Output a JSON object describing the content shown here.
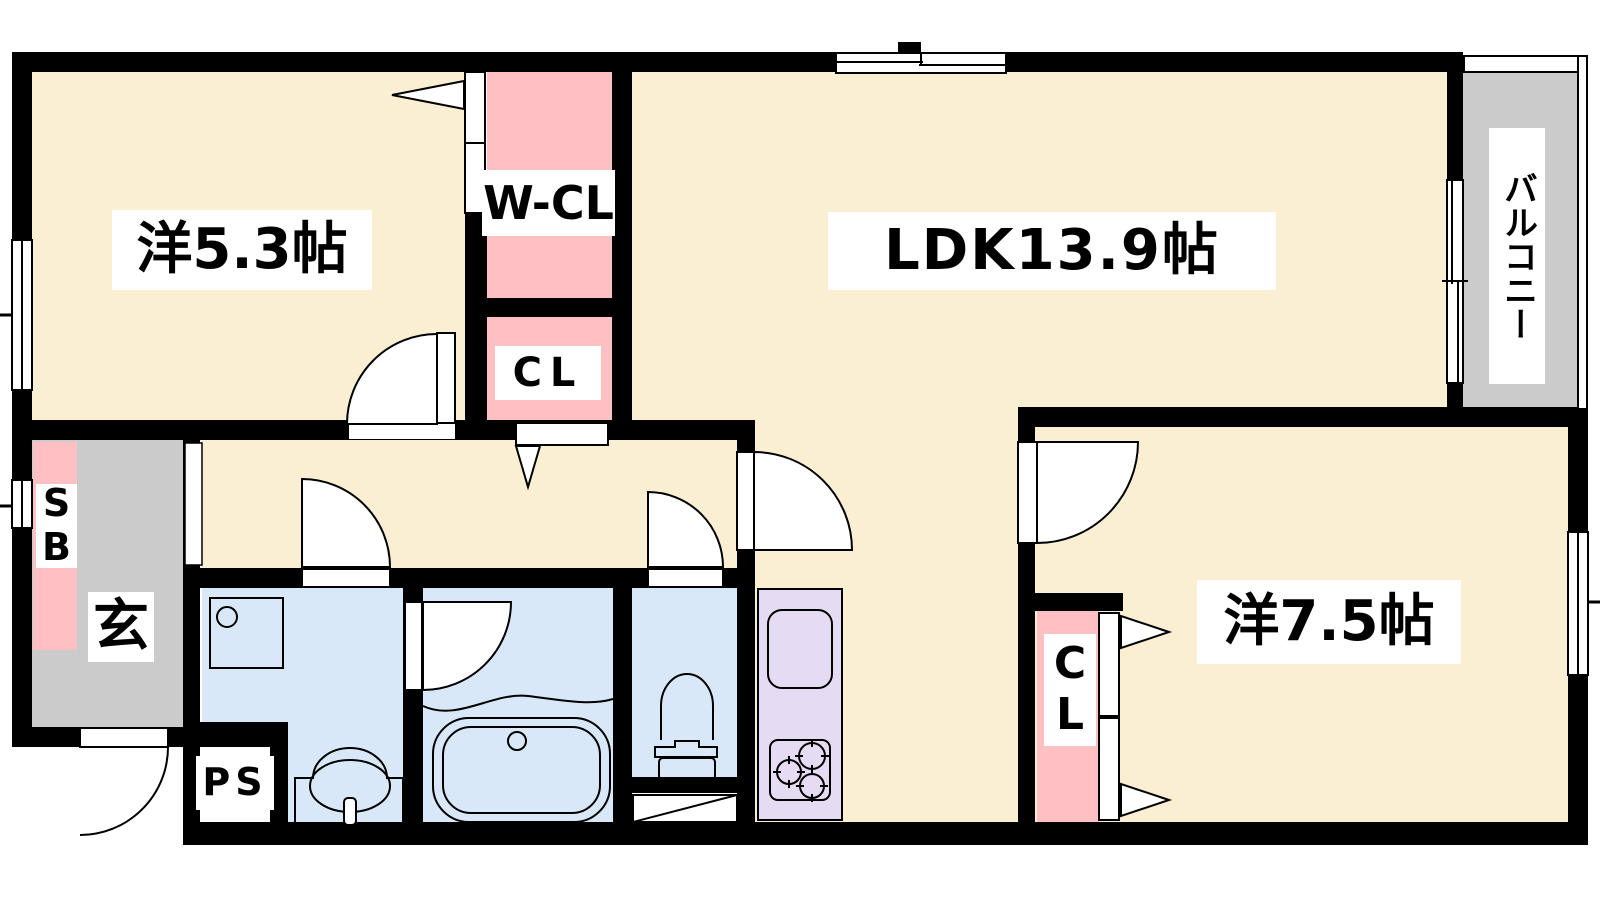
{
  "floorplan": {
    "labels": {
      "room53": "洋5.3帖",
      "wcl": "W-CL",
      "cl_hall": "CL",
      "ldk": "LDK13.9帖",
      "balcony": "バルコニー",
      "shoebox": "S\nB",
      "entrance": "玄",
      "ps": "PS",
      "cl_bedroom": "C\nL",
      "room75": "洋7.5帖"
    },
    "colors": {
      "floor": "#faefd2",
      "closet": "#ffc0c3",
      "wet": "#d8e8f8",
      "kitchen": "#e5dbf2",
      "gray": "#cbcbcb",
      "wall": "#000000"
    }
  }
}
